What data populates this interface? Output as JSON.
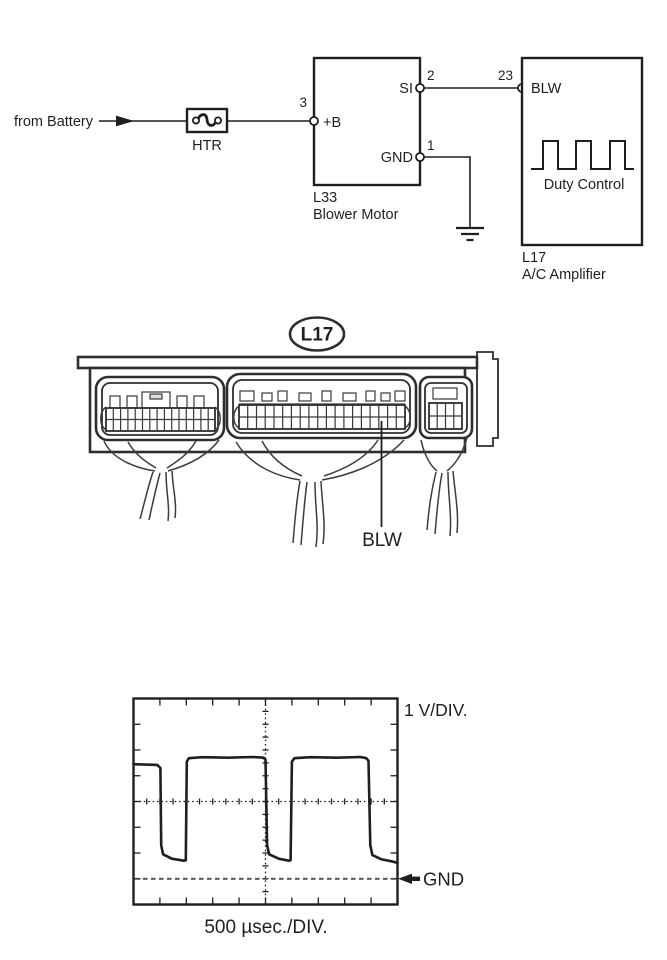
{
  "colors": {
    "ink": "#1f1f1f",
    "line_art": "#2e2e2e",
    "harness": "#3c3c3c",
    "gnd_dashed_line": "#4a4a4a",
    "background": "#ffffff"
  },
  "circuit": {
    "source_label": "from Battery",
    "fuse_label": "HTR",
    "blower_motor": {
      "code": "L33",
      "name": "Blower Motor",
      "pins": {
        "b_plus": {
          "label": "+B",
          "number": "3"
        },
        "si": {
          "label": "SI",
          "number": "2"
        },
        "gnd": {
          "label": "GND",
          "number": "1"
        }
      }
    },
    "ac_amplifier": {
      "code": "L17",
      "name": "A/C Amplifier",
      "duty_label": "Duty Control",
      "pins": {
        "blw": {
          "label": "BLW",
          "number": "23"
        }
      }
    }
  },
  "connector_view": {
    "component_label": "L17",
    "signal_label": "BLW"
  },
  "oscilloscope": {
    "vertical_scale": "1 V/DIV.",
    "horizontal_scale": "500 µsec./DIV.",
    "ground_label": "GND"
  },
  "chart_data": {
    "type": "line",
    "title": "Blower motor duty control signal at BLW terminal",
    "x_unit": "µsec",
    "y_unit": "V",
    "x_per_division": 500,
    "volts_per_div": 1,
    "divisions_x": 10,
    "divisions_y": 8,
    "gnd_div_from_top": 7,
    "high_level_v": 4.7,
    "low_level_v": 0.7,
    "period_divisions": 4,
    "duty_cycle_high_pct": 76,
    "grid": "center crosshair dotted, border ticks each division, dashed GND reference 3 divisions below center",
    "points": [
      [
        0,
        4.45
      ],
      [
        0.9,
        4.42
      ],
      [
        1.02,
        4.3
      ],
      [
        1.05,
        1.3
      ],
      [
        1.12,
        0.95
      ],
      [
        1.45,
        0.78
      ],
      [
        1.9,
        0.7
      ],
      [
        1.98,
        0.72
      ],
      [
        2.02,
        4.55
      ],
      [
        2.1,
        4.68
      ],
      [
        2.6,
        4.72
      ],
      [
        3.6,
        4.7
      ],
      [
        4.5,
        4.73
      ],
      [
        4.92,
        4.7
      ],
      [
        5.0,
        4.62
      ],
      [
        5.06,
        1.3
      ],
      [
        5.14,
        0.95
      ],
      [
        5.5,
        0.78
      ],
      [
        5.88,
        0.7
      ],
      [
        5.95,
        0.72
      ],
      [
        6.0,
        4.55
      ],
      [
        6.1,
        4.68
      ],
      [
        6.7,
        4.72
      ],
      [
        7.7,
        4.7
      ],
      [
        8.6,
        4.73
      ],
      [
        8.82,
        4.68
      ],
      [
        8.9,
        4.58
      ],
      [
        8.97,
        1.3
      ],
      [
        9.05,
        0.92
      ],
      [
        9.4,
        0.75
      ],
      [
        9.75,
        0.68
      ],
      [
        10,
        0.62
      ]
    ]
  }
}
